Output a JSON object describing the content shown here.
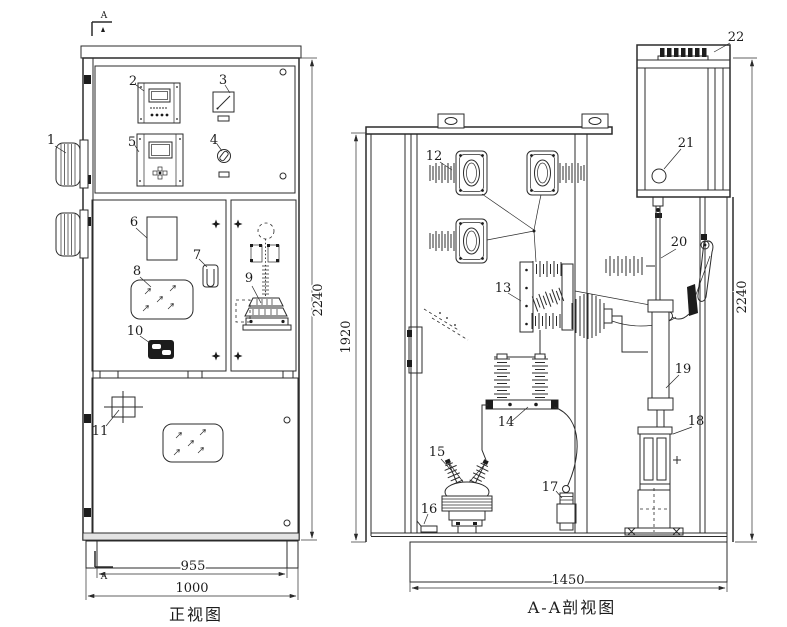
{
  "drawing": {
    "type": "technical-engineering-drawing",
    "subject": "switchgear cabinet two-view drawing",
    "colors": {
      "line": "#2b2b2b",
      "background": "#ffffff",
      "solid_fill": "#1c1c1c"
    },
    "section_marker": "A",
    "views": {
      "front": {
        "caption": "正视图"
      },
      "section": {
        "caption": "A-A剖视图"
      }
    },
    "dimensions": {
      "front_height": "2240",
      "front_inner_width": "955",
      "front_width": "1000",
      "section_inner_height": "1920",
      "section_height": "2240",
      "section_width": "1450"
    },
    "part_labels": [
      "1",
      "2",
      "3",
      "4",
      "5",
      "6",
      "7",
      "8",
      "9",
      "10",
      "11",
      "12",
      "13",
      "14",
      "15",
      "16",
      "17",
      "18",
      "19",
      "20",
      "21",
      "22"
    ]
  }
}
